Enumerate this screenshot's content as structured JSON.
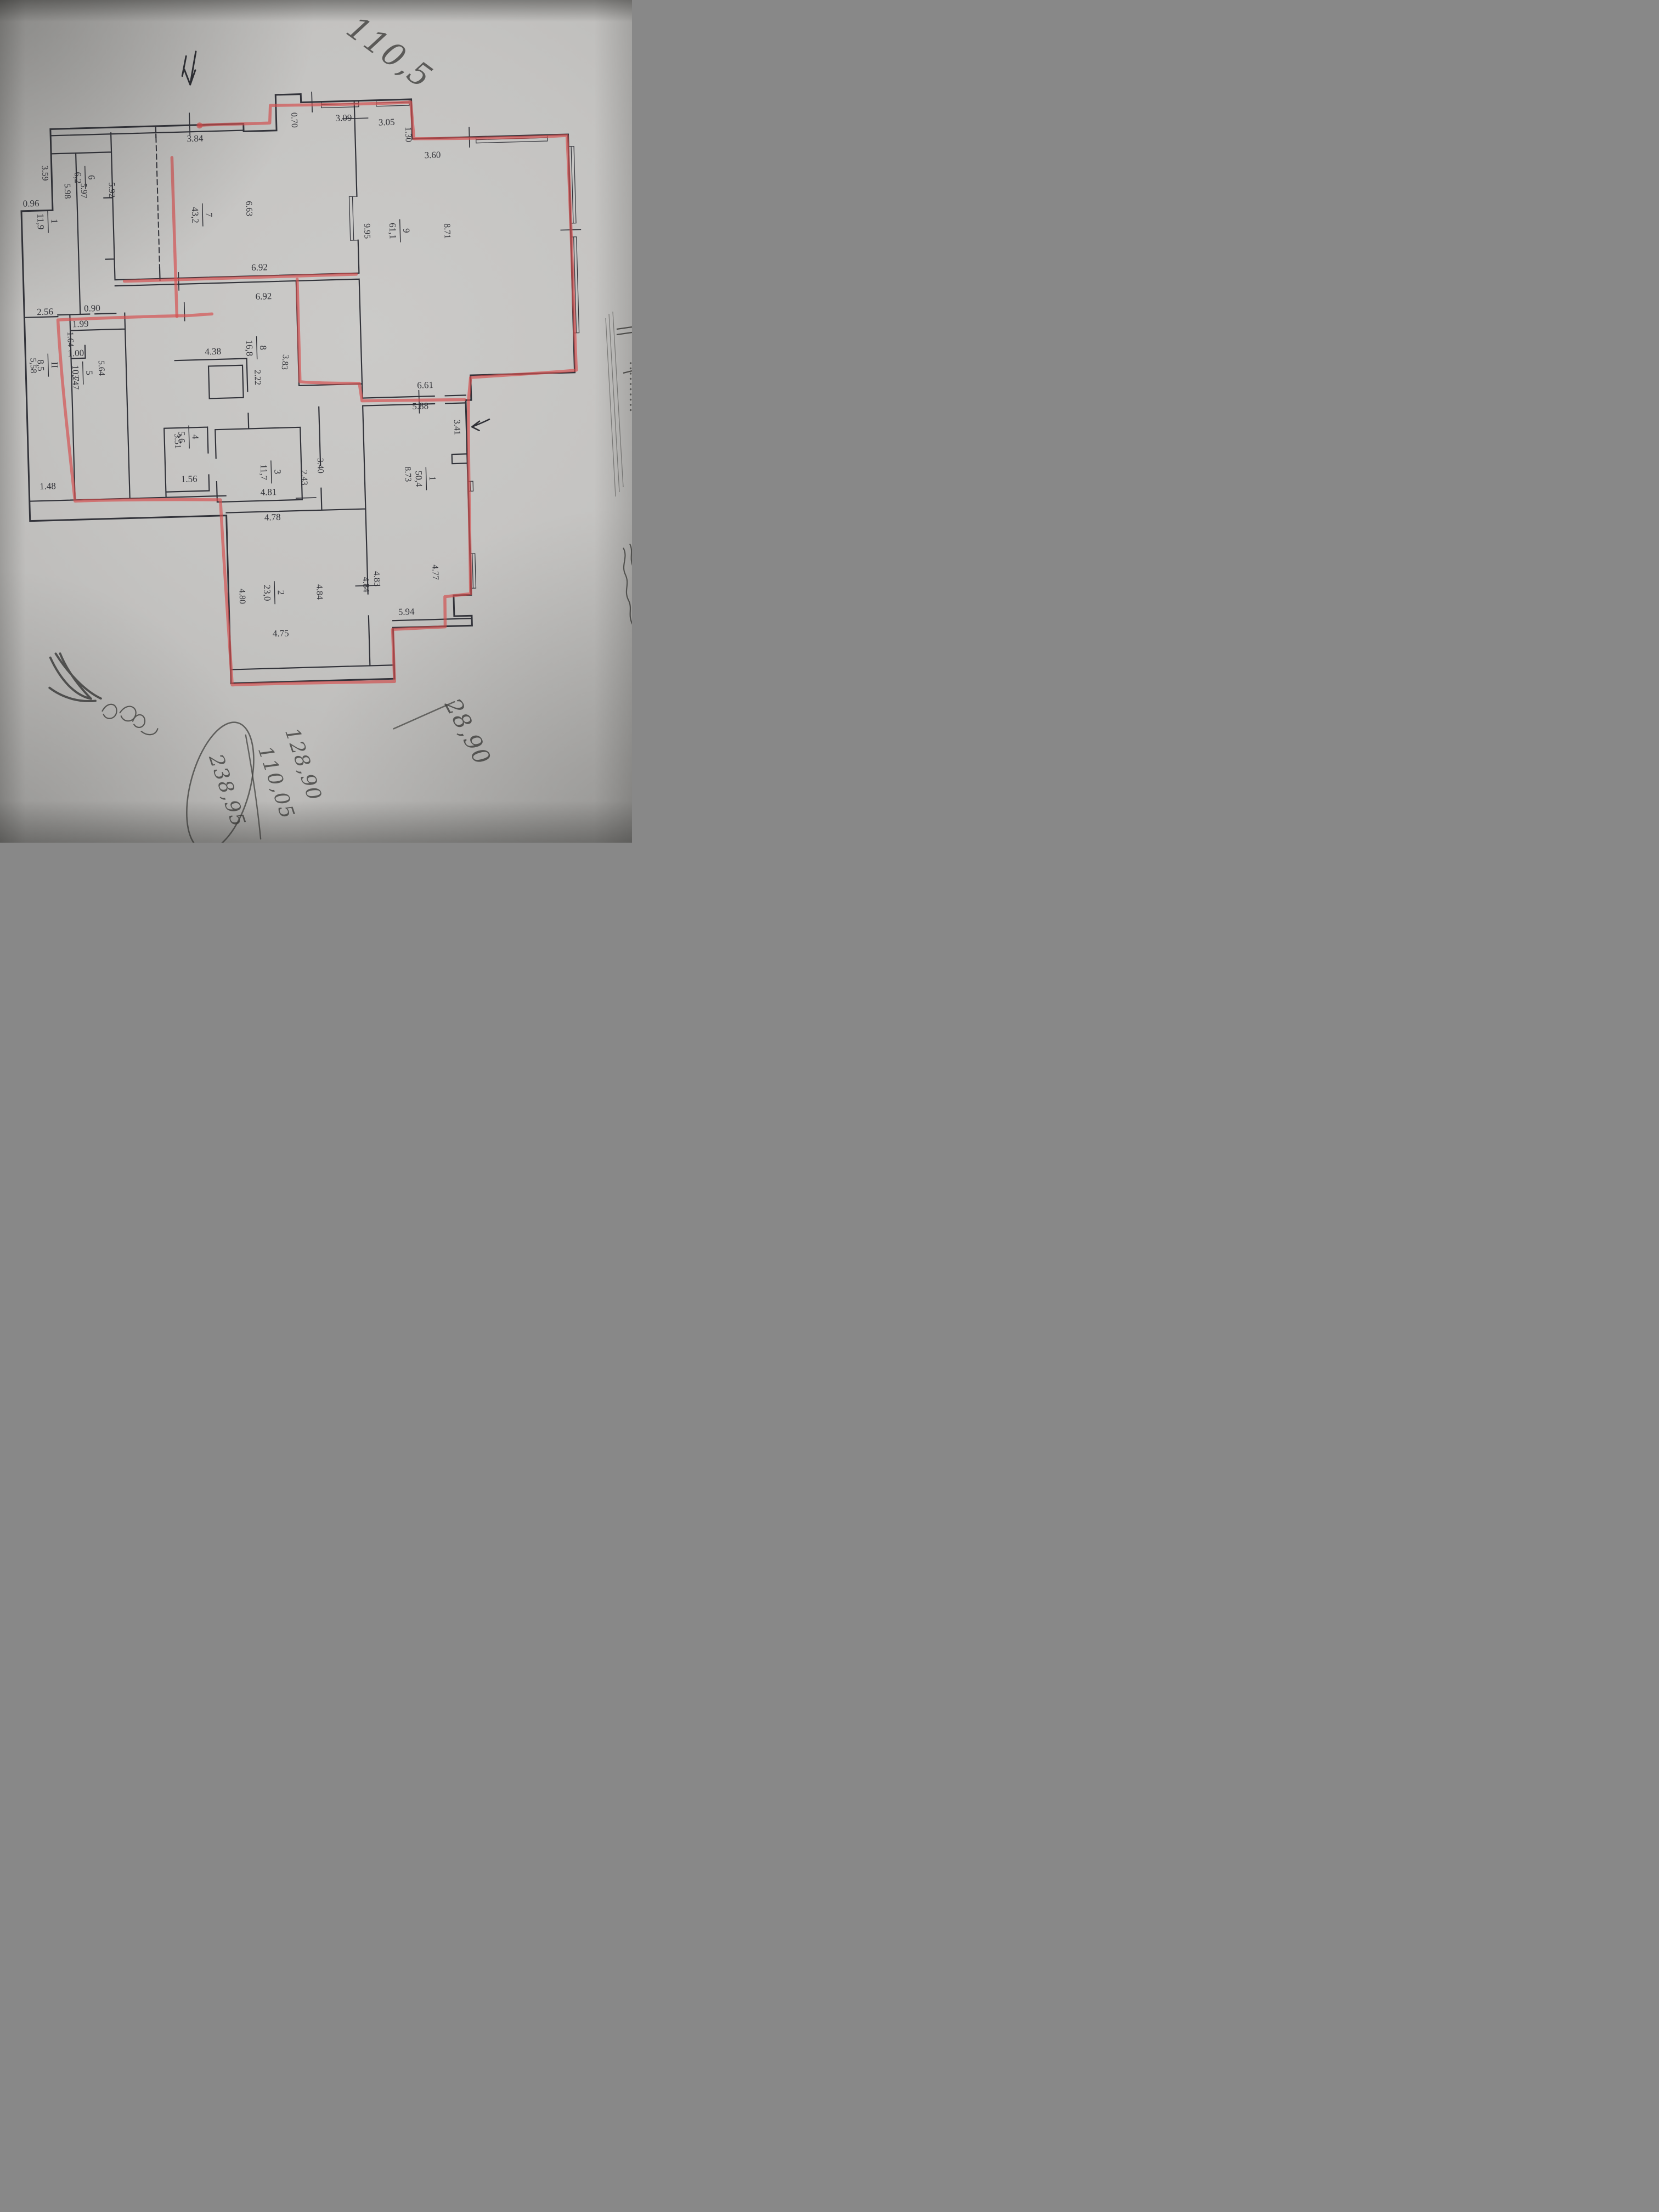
{
  "document": {
    "kind": "photographed floor plan sheet",
    "marker_trace_color": "#d64f4f",
    "paper_color": "#c4c3c1",
    "ink_color": "#2b2c32",
    "pencil_color": "#41413f"
  },
  "dims": [
    "3.84",
    "0.70",
    "3.09",
    "3.05",
    "1.30",
    "3.60",
    "8.71",
    "9.95",
    "6.63",
    "5.92",
    "5.97",
    "5.98",
    "3.59",
    "0.96",
    "2.56",
    "0.90",
    "6.92",
    "6.92",
    "1.99",
    "1.64",
    "1.00",
    "5.64",
    "3.47",
    "5,58",
    "1.48",
    "4.38",
    "2.22",
    "3.83",
    "3.51",
    "1.56",
    "4.81",
    "2.43",
    "3.40",
    "4.78",
    "5.88",
    "6.61",
    "3.41",
    "8.73",
    "4.77",
    "4.83",
    "4.84",
    "4.84",
    "4.80",
    "4.75",
    "5.94"
  ],
  "rooms": [
    {
      "num": "1",
      "area": "11,9"
    },
    {
      "num": "6",
      "area": "6,2"
    },
    {
      "num": "7",
      "area": "43,2"
    },
    {
      "num": "9",
      "area": "61,1"
    },
    {
      "num": "8",
      "area": "16,8"
    },
    {
      "num": "5",
      "area": "10,7"
    },
    {
      "num": "II",
      "area": "8,5"
    },
    {
      "num": "4",
      "area": "5,6"
    },
    {
      "num": "3",
      "area": "11,7"
    },
    {
      "num": "1",
      "area": "50,4"
    },
    {
      "num": "2",
      "area": "23,0"
    }
  ],
  "hand": [
    "110,5",
    "28,90",
    "128,90",
    "110,05",
    "238,95"
  ],
  "scribbles": {
    "bottom_left": "illegible pen scribble (looks like № 85 b)",
    "right_edge": "illegible cursive handwriting, cut off by photo edge"
  }
}
